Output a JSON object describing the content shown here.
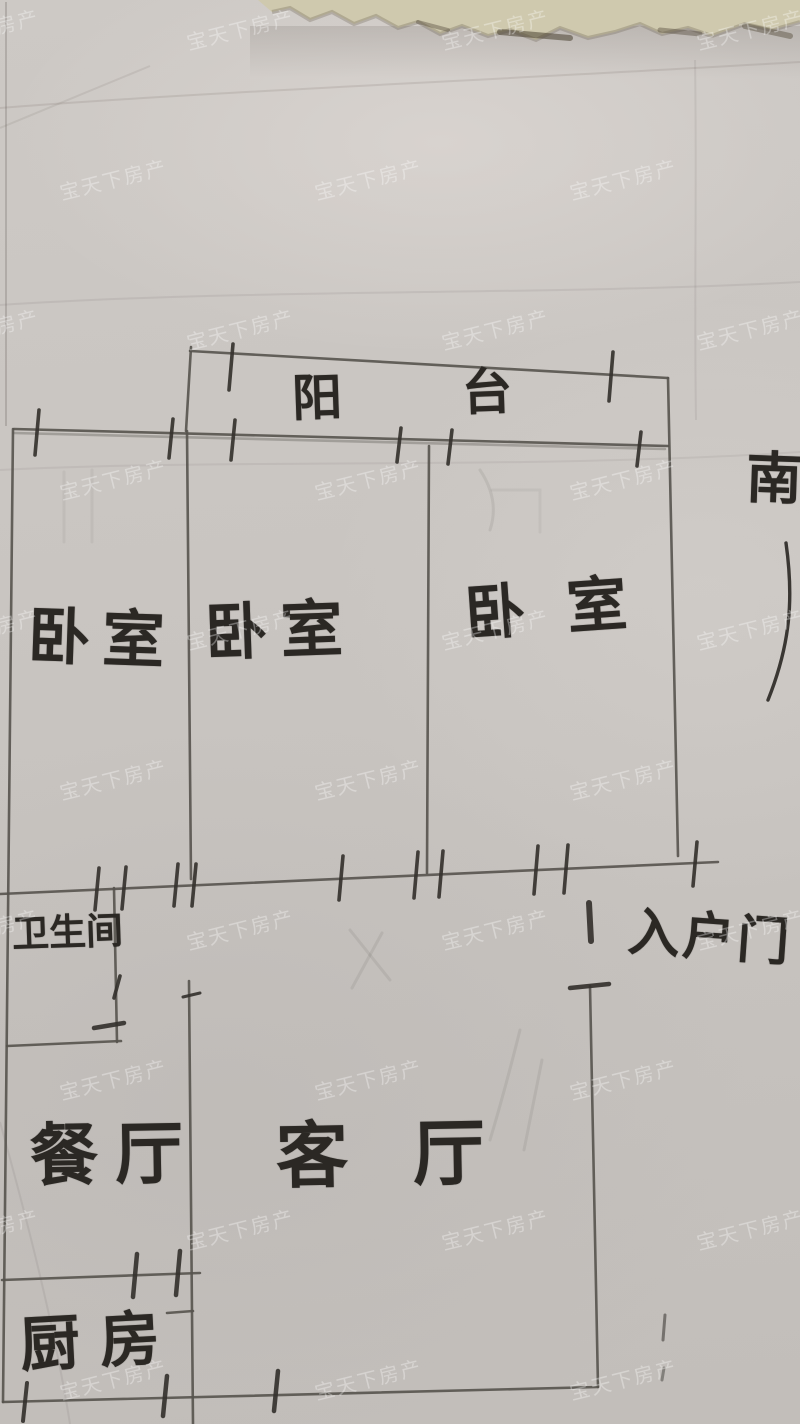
{
  "document": {
    "kind": "hand-drawn apartment floor plan on paper",
    "orientation_note": "south marker on right edge"
  },
  "rooms": [
    {
      "id": "balcony",
      "label": "阳台"
    },
    {
      "id": "bedroom-left",
      "label": "卧室"
    },
    {
      "id": "bedroom-middle",
      "label": "卧室"
    },
    {
      "id": "bedroom-right",
      "label": "卧室"
    },
    {
      "id": "bathroom",
      "label": "卫生间"
    },
    {
      "id": "dining-room",
      "label": "餐厅"
    },
    {
      "id": "living-room",
      "label": "客厅"
    },
    {
      "id": "kitchen",
      "label": "厨房"
    }
  ],
  "entry": {
    "label": "入户门"
  },
  "compass": {
    "south_label": "南"
  },
  "watermark": {
    "text": "宝天下房产",
    "color": "rgba(255,255,255,0.33)"
  },
  "colors": {
    "paper": "#c9c5c1",
    "torn_strip": "#cfc9ae",
    "pencil_wall": "#57534e",
    "pencil_tick": "#35322e",
    "handwriting_ink": "#2b2824"
  }
}
